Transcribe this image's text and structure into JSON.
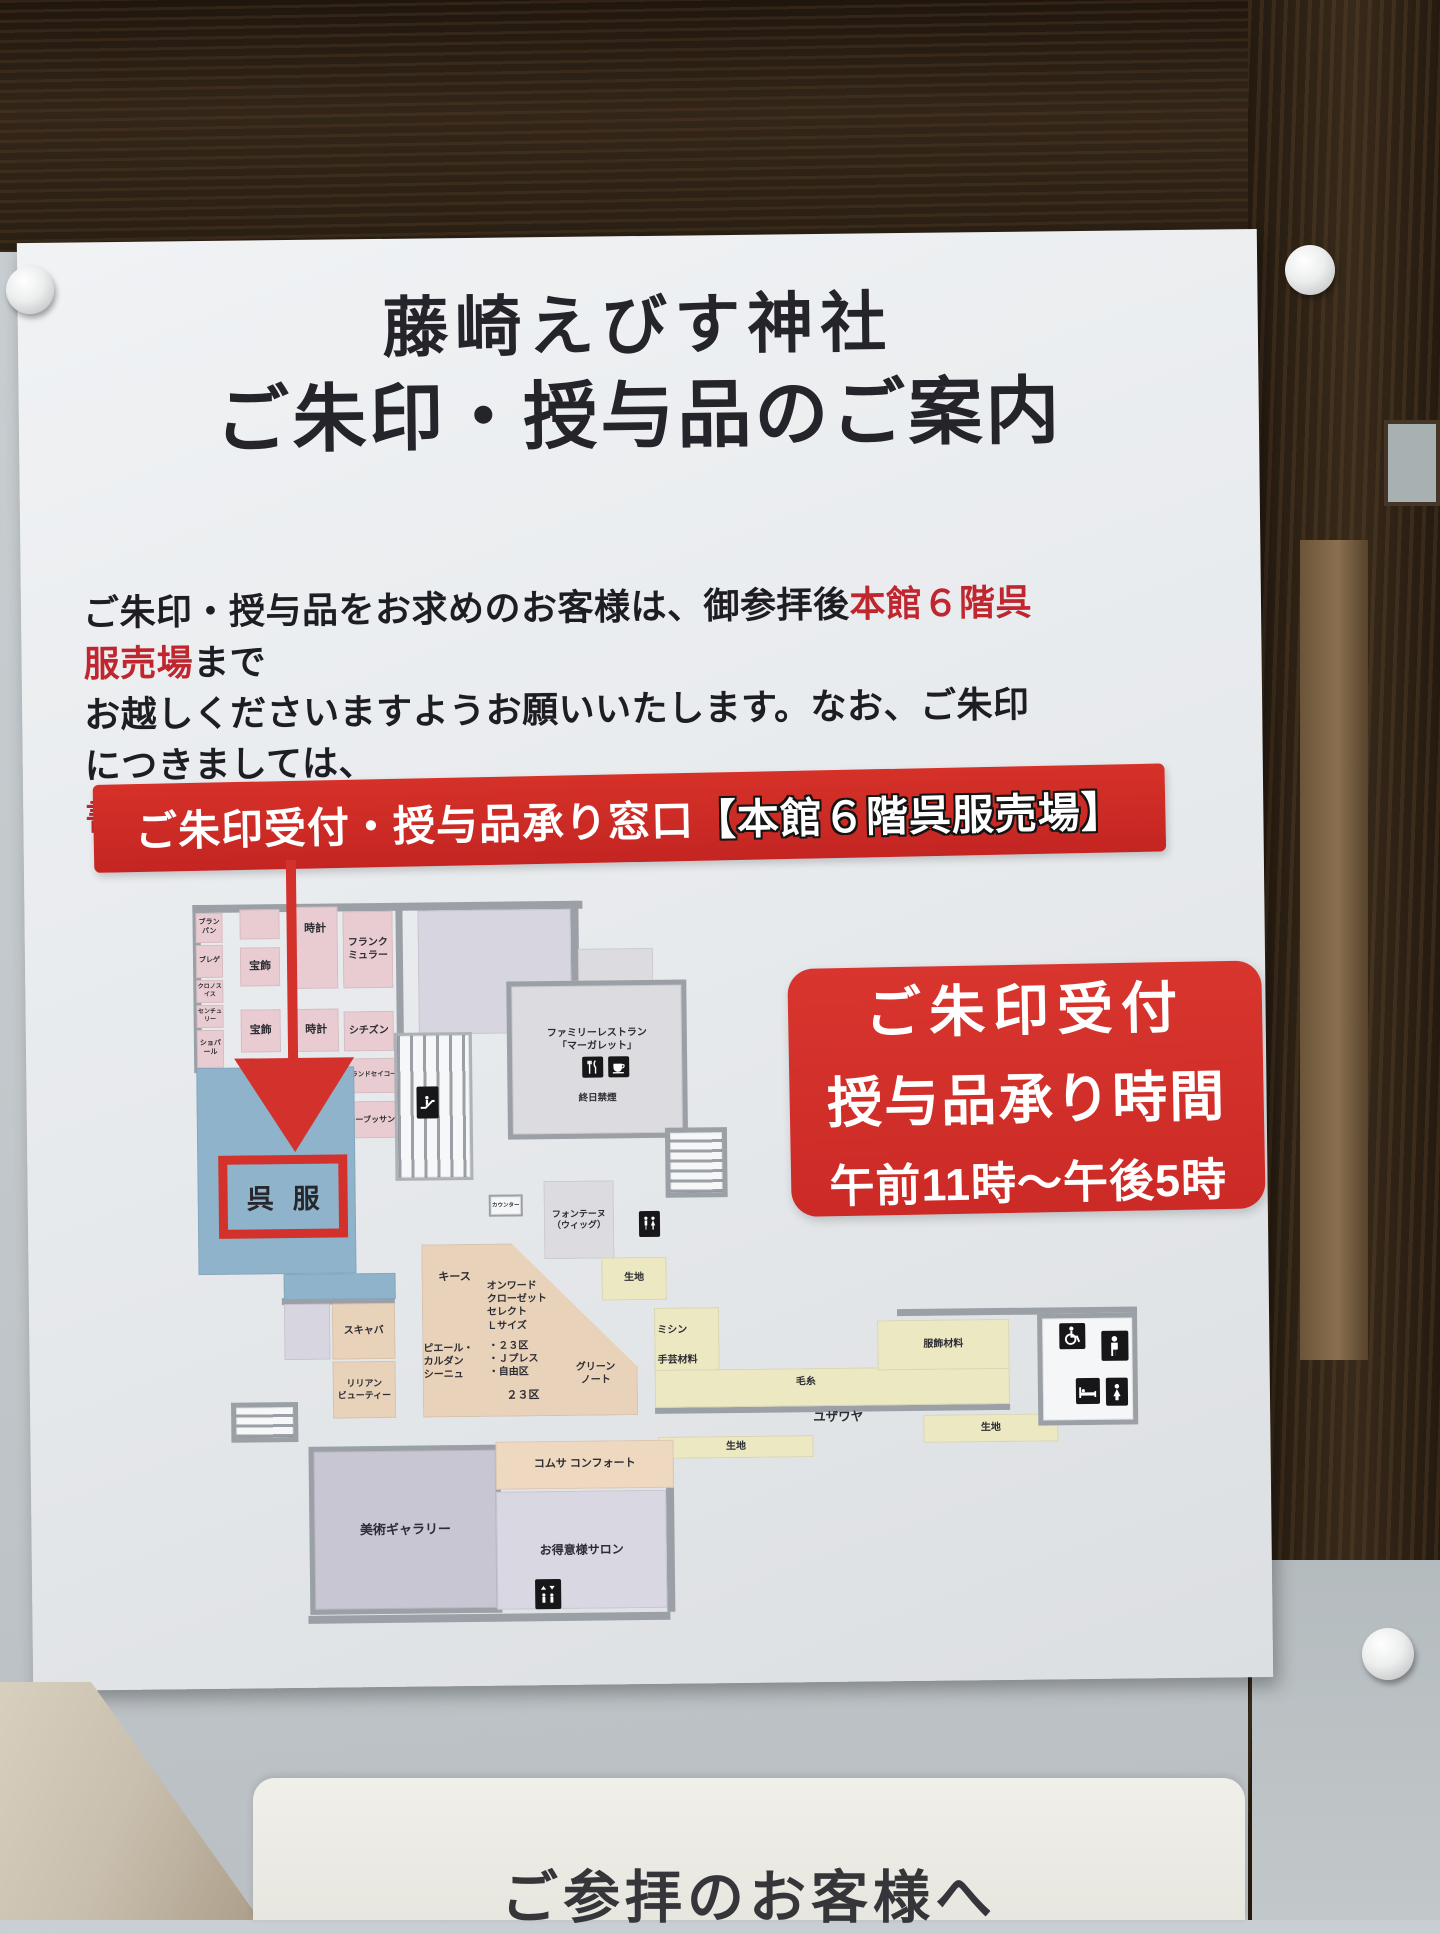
{
  "sign": {
    "title_line1": "藤崎えびす神社",
    "title_line2": "ご朱印・授与品のご案内",
    "paragraph": {
      "line1_pre": "ご朱印・授与品をお求めのお客様は、御参拝後",
      "line1_red": "本館６階呉服売場",
      "line1_post": "まで",
      "line2": "お越しくださいますようお願いいたします。なお、ご朱印につきましては、",
      "line3_red": "書き置きの御朱印",
      "line3_post": "をお渡しいたします。"
    },
    "banner": {
      "text_main": "ご朱印受付・授与品承り窓口",
      "text_bracket": "【本館６階呉服売場】"
    },
    "info_box": {
      "line1": "ご朱印受付",
      "line2": "授与品承り時間",
      "line3": "午前11時〜午後5時"
    },
    "colors": {
      "banner_red": "#cc2a27",
      "info_red": "#d2302b",
      "accent_text_red": "#c0262e",
      "highlight_outline": "#d2312c"
    }
  },
  "map": {
    "highlight_label": "呉服",
    "colors": {
      "pink": "#e8ccd1",
      "blue": "#8fb3ca",
      "lavender": "#d7d5df",
      "lavender2": "#c9c6d4",
      "gray": "#dcdbe0",
      "peach": "#e9d2ba",
      "peachlight": "#eed9c0",
      "yellow": "#ebe8c2",
      "salon": "#d9d7e2",
      "white": "#f5f6f7",
      "wall": "#9aa0a6"
    },
    "walls": [
      {
        "x": 0,
        "y": 0,
        "w": 390,
        "h": 8
      },
      {
        "x": 0,
        "y": 0,
        "w": 8,
        "h": 168
      },
      {
        "x": 378,
        "y": 0,
        "w": 8,
        "h": 132
      },
      {
        "x": 203,
        "y": 5,
        "w": 7,
        "h": 128
      },
      {
        "x": 85,
        "y": 394,
        "w": 113,
        "h": 7
      },
      {
        "x": 108,
        "y": 712,
        "w": 362,
        "h": 8
      },
      {
        "x": 467,
        "y": 540,
        "w": 8,
        "h": 172
      },
      {
        "x": 700,
        "y": 412,
        "w": 240,
        "h": 7
      },
      {
        "x": 457,
        "y": 508,
        "w": 355,
        "h": 6
      }
    ],
    "regions": [
      {
        "id": "blancpain",
        "x": 3,
        "y": 8,
        "w": 27,
        "h": 30,
        "c": "pink",
        "label": "ブランパン",
        "fs": 7
      },
      {
        "id": "breguet",
        "x": 3,
        "y": 40,
        "w": 27,
        "h": 33,
        "c": "pink",
        "label": "ブレゲ",
        "fs": 7
      },
      {
        "id": "chronoswiss",
        "x": 3,
        "y": 75,
        "w": 27,
        "h": 23,
        "c": "pink",
        "label": "クロノスイス",
        "fs": 6
      },
      {
        "id": "century",
        "x": 3,
        "y": 100,
        "w": 27,
        "h": 23,
        "c": "pink",
        "label": "センチュリー",
        "fs": 6
      },
      {
        "id": "chopard",
        "x": 3,
        "y": 125,
        "w": 27,
        "h": 38,
        "c": "pink",
        "label": "ショパール",
        "fs": 7
      },
      {
        "id": "pink-annex",
        "x": 47,
        "y": 5,
        "w": 40,
        "h": 30,
        "c": "pink",
        "label": "",
        "fs": 8
      },
      {
        "id": "hoshoku-1",
        "x": 47,
        "y": 43,
        "w": 40,
        "h": 39,
        "c": "pink",
        "label": "宝飾",
        "fs": 11
      },
      {
        "id": "tokei-1",
        "x": 100,
        "y": 3,
        "w": 45,
        "h": 82,
        "c": "pink",
        "label": "時計",
        "fs": 11,
        "va": "top"
      },
      {
        "id": "franck-muller",
        "x": 150,
        "y": 8,
        "w": 50,
        "h": 77,
        "c": "pink",
        "label": "フランク\nミュラー",
        "fs": 10
      },
      {
        "id": "hoshoku-2",
        "x": 47,
        "y": 105,
        "w": 40,
        "h": 43,
        "c": "pink",
        "label": "宝飾",
        "fs": 11
      },
      {
        "id": "tokei-2",
        "x": 100,
        "y": 105,
        "w": 45,
        "h": 43,
        "c": "pink",
        "label": "時計",
        "fs": 11
      },
      {
        "id": "citizen",
        "x": 150,
        "y": 108,
        "w": 50,
        "h": 40,
        "c": "pink",
        "label": "シチズン",
        "fs": 10
      },
      {
        "id": "grand-seiko",
        "x": 150,
        "y": 155,
        "w": 53,
        "h": 35,
        "c": "pink",
        "label": "グランドセイコー",
        "fs": 6.5
      },
      {
        "id": "otsuki-pearl",
        "x": 100,
        "y": 163,
        "w": 43,
        "h": 48,
        "c": "pink",
        "label": "大月パール",
        "fs": 7,
        "va": "bottom"
      },
      {
        "id": "mauboussin",
        "x": 150,
        "y": 198,
        "w": 53,
        "h": 37,
        "c": "pink",
        "label": "モーブッサン",
        "fs": 8
      },
      {
        "id": "gofuku-blue",
        "x": 2,
        "y": 163,
        "w": 158,
        "h": 207,
        "c": "blue",
        "label": "",
        "fs": 0
      },
      {
        "id": "gofuku-blue-ext",
        "x": 87,
        "y": 370,
        "w": 112,
        "h": 26,
        "c": "blue",
        "label": "",
        "fs": 0
      },
      {
        "id": "event-space",
        "x": 225,
        "y": 8,
        "w": 153,
        "h": 124,
        "c": "lavender",
        "label": "",
        "fs": 0
      },
      {
        "id": "restaurant-upper",
        "x": 385,
        "y": 48,
        "w": 75,
        "h": 34,
        "c": "gray",
        "label": "",
        "fs": 0
      },
      {
        "id": "restaurant",
        "x": 313,
        "y": 80,
        "w": 180,
        "h": 158,
        "c": "gray",
        "border": true,
        "label": "",
        "fs": 0
      },
      {
        "id": "escalator-bank",
        "x": 200,
        "y": 130,
        "w": 78,
        "h": 148,
        "stairs": "v",
        "label": "",
        "fs": 0
      },
      {
        "id": "stairs-right",
        "x": 470,
        "y": 228,
        "w": 62,
        "h": 70,
        "stairs": "h",
        "label": "",
        "fs": 0
      },
      {
        "id": "counter",
        "x": 293,
        "y": 293,
        "w": 34,
        "h": 22,
        "c": "white",
        "border2": true,
        "label": "カウンター",
        "fs": 5.5
      },
      {
        "id": "fontaine-wig",
        "x": 348,
        "y": 280,
        "w": 70,
        "h": 78,
        "c": "gray",
        "label": "フォンテーヌ\n（ウィッグ）",
        "fs": 9
      },
      {
        "id": "kiji-center",
        "x": 405,
        "y": 357,
        "w": 65,
        "h": 43,
        "c": "yellow",
        "label": "生地",
        "fs": 10
      },
      {
        "id": "onward-area",
        "x": 225,
        "y": 342,
        "w": 215,
        "h": 173,
        "c": "peach",
        "clip": "polygon(0 0,42% 0,100% 72%,100% 100%,0 100%)",
        "label": "",
        "fs": 0
      },
      {
        "id": "box-annex",
        "x": 87,
        "y": 400,
        "w": 46,
        "h": 56,
        "c": "lavender",
        "label": "",
        "fs": 0
      },
      {
        "id": "scabal",
        "x": 135,
        "y": 400,
        "w": 63,
        "h": 56,
        "c": "peach",
        "label": "スキャバ",
        "fs": 10
      },
      {
        "id": "lilian-beauty",
        "x": 135,
        "y": 458,
        "w": 63,
        "h": 57,
        "c": "peach",
        "label": "リリアン\nビューティー",
        "fs": 9
      },
      {
        "id": "stairs-left",
        "x": 33,
        "y": 498,
        "w": 67,
        "h": 40,
        "stairs": "h",
        "label": "",
        "fs": 0
      },
      {
        "id": "mishin-area",
        "x": 457,
        "y": 408,
        "w": 65,
        "h": 65,
        "c": "yellow",
        "label": "",
        "fs": 0
      },
      {
        "id": "keito-bar",
        "x": 457,
        "y": 470,
        "w": 355,
        "h": 38,
        "c": "yellow",
        "label": "",
        "fs": 0
      },
      {
        "id": "fukushoku",
        "x": 680,
        "y": 423,
        "w": 132,
        "h": 50,
        "c": "yellow",
        "label": "服飾材料",
        "fs": 10
      },
      {
        "id": "kiji-right",
        "x": 725,
        "y": 518,
        "w": 135,
        "h": 28,
        "c": "yellow",
        "label": "生地",
        "fs": 10
      },
      {
        "id": "kiji-left",
        "x": 460,
        "y": 537,
        "w": 155,
        "h": 22,
        "c": "yellow",
        "label": "生地",
        "fs": 10
      },
      {
        "id": "wc-room",
        "x": 840,
        "y": 418,
        "w": 100,
        "h": 112,
        "c": "white",
        "border": true,
        "label": "",
        "fs": 0
      },
      {
        "id": "bijutsu-gallery",
        "x": 110,
        "y": 543,
        "w": 192,
        "h": 168,
        "c": "lavender2",
        "border": true,
        "label": "美術ギャラリー",
        "fs": 13
      },
      {
        "id": "comme-ca",
        "x": 297,
        "y": 540,
        "w": 178,
        "h": 48,
        "c": "peachlight",
        "label": "コムサ コンフォート",
        "fs": 11
      },
      {
        "id": "salon",
        "x": 297,
        "y": 590,
        "w": 170,
        "h": 118,
        "c": "salon",
        "label": "お得意様サロン",
        "fs": 12
      }
    ],
    "labels": [
      {
        "id": "restaurant-name",
        "x": 313,
        "y": 126,
        "w": 180,
        "text": "ファミリーレストラン\n「マーガレット」",
        "fs": 10,
        "align": "center"
      },
      {
        "id": "restaurant-note",
        "x": 313,
        "y": 192,
        "w": 180,
        "text": "終日禁煙",
        "fs": 9.5,
        "align": "center"
      },
      {
        "id": "keith",
        "x": 228,
        "y": 368,
        "w": 60,
        "text": "キース",
        "fs": 11,
        "align": "center"
      },
      {
        "id": "onward-closet",
        "x": 290,
        "y": 378,
        "w": 80,
        "text": "オンワード\nクローゼット\nセレクト\nＬサイズ",
        "fs": 10,
        "align": "left"
      },
      {
        "id": "brands-23ku",
        "x": 291,
        "y": 438,
        "w": 80,
        "text": "・２３区\n・Ｊプレス\n・自由区",
        "fs": 10,
        "align": "left"
      },
      {
        "id": "pierre-cardin",
        "x": 226,
        "y": 440,
        "w": 62,
        "text": "ピエール・\nカルダン\nシーニュ",
        "fs": 10,
        "align": "left"
      },
      {
        "id": "ku-23",
        "x": 300,
        "y": 487,
        "w": 50,
        "text": "２３区",
        "fs": 11,
        "align": "center"
      },
      {
        "id": "green-note",
        "x": 368,
        "y": 460,
        "w": 60,
        "text": "グリーン\nノート",
        "fs": 10,
        "align": "center"
      },
      {
        "id": "mishin",
        "x": 460,
        "y": 424,
        "w": 50,
        "text": "ミシン",
        "fs": 10,
        "align": "left"
      },
      {
        "id": "shugei",
        "x": 460,
        "y": 454,
        "w": 60,
        "text": "手芸材料",
        "fs": 10,
        "align": "left"
      },
      {
        "id": "keito",
        "x": 583,
        "y": 477,
        "w": 50,
        "text": "毛糸",
        "fs": 10,
        "align": "center"
      },
      {
        "id": "yuzawaya",
        "x": 600,
        "y": 511,
        "w": 80,
        "text": "ユザワヤ",
        "fs": 12.5,
        "align": "center"
      }
    ],
    "icons": [
      {
        "type": "escalator",
        "x": 222,
        "y": 184,
        "w": 22,
        "h": 32
      },
      {
        "type": "fork",
        "x": 388,
        "y": 156,
        "w": 21,
        "h": 21
      },
      {
        "type": "cafe",
        "x": 414,
        "y": 156,
        "w": 21,
        "h": 21
      },
      {
        "type": "wc",
        "x": 443,
        "y": 311,
        "w": 21,
        "h": 26
      },
      {
        "type": "wheelchair",
        "x": 862,
        "y": 428,
        "w": 26,
        "h": 26
      },
      {
        "type": "male",
        "x": 904,
        "y": 436,
        "w": 27,
        "h": 30
      },
      {
        "type": "bed",
        "x": 878,
        "y": 483,
        "w": 24,
        "h": 26
      },
      {
        "type": "female",
        "x": 908,
        "y": 483,
        "w": 22,
        "h": 28
      },
      {
        "type": "elevator",
        "x": 335,
        "y": 678,
        "w": 26,
        "h": 30
      }
    ]
  },
  "bottom_sign": {
    "text": "ご参拝のお客様へ"
  }
}
